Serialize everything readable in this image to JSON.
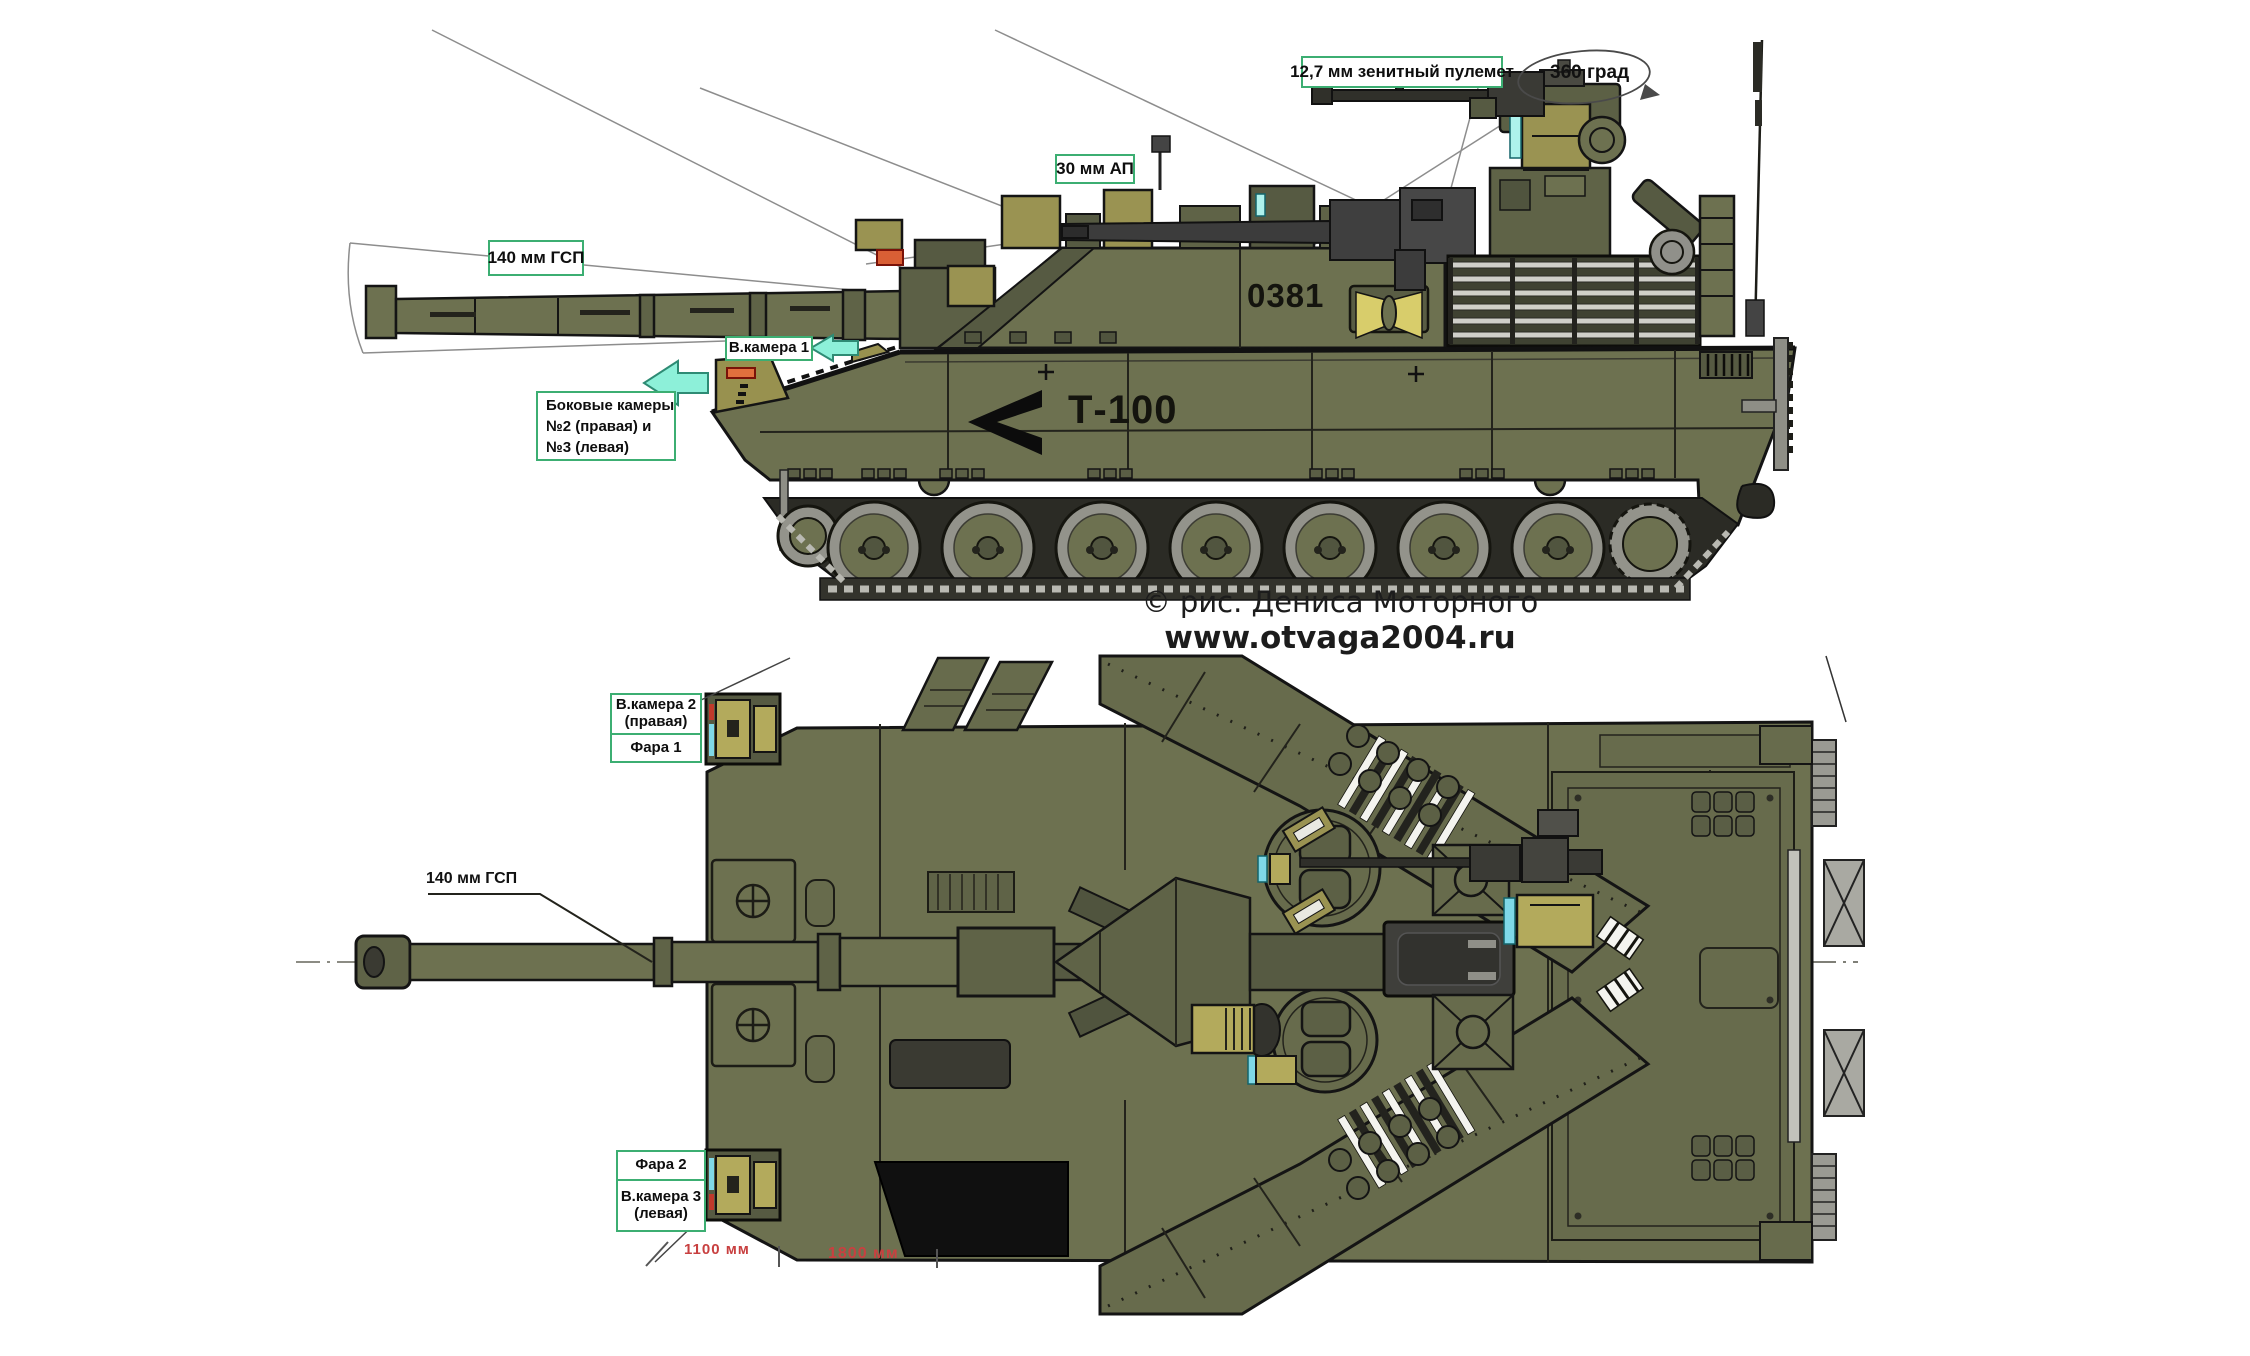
{
  "colors": {
    "label_border": "#3cae72",
    "dimension_red": "#c84040",
    "arrow_fill": "#8df0d9",
    "arrow_border": "#2e8b74",
    "hull_olive": "#6d7150",
    "khaki": "#b3aa5c",
    "optic_cyan": "#7fd8e8",
    "camera_orange": "#e2703d"
  },
  "side_view": {
    "labels": {
      "machine_gun": "12,7 мм зенитный пулемет",
      "rotation": "360 град",
      "autocannon": "30 мм АП",
      "main_gun": "140 мм ГСП",
      "camera_1": "В.камера 1",
      "side_cameras": {
        "lines": [
          "Боковые камеры",
          "№2 (правая) и",
          "№3 (левая)"
        ]
      }
    },
    "markings": {
      "turret_number": "0381",
      "hull_name": "Т-100"
    }
  },
  "credit": {
    "line1": "© рис. Дениса Моторного",
    "line2": "www.otvaga2004.ru"
  },
  "top_view": {
    "labels": {
      "camera_2": {
        "lines": [
          "В.камера 2",
          "(правая)"
        ]
      },
      "headlight_1": "Фара 1",
      "main_gun": "140 мм ГСП",
      "headlight_2": "Фара 2",
      "camera_3": {
        "lines": [
          "В.камера 3",
          "(левая)"
        ]
      }
    },
    "dimensions": {
      "front_overhang": "1100 мм",
      "front_section": "1800 мм"
    }
  }
}
